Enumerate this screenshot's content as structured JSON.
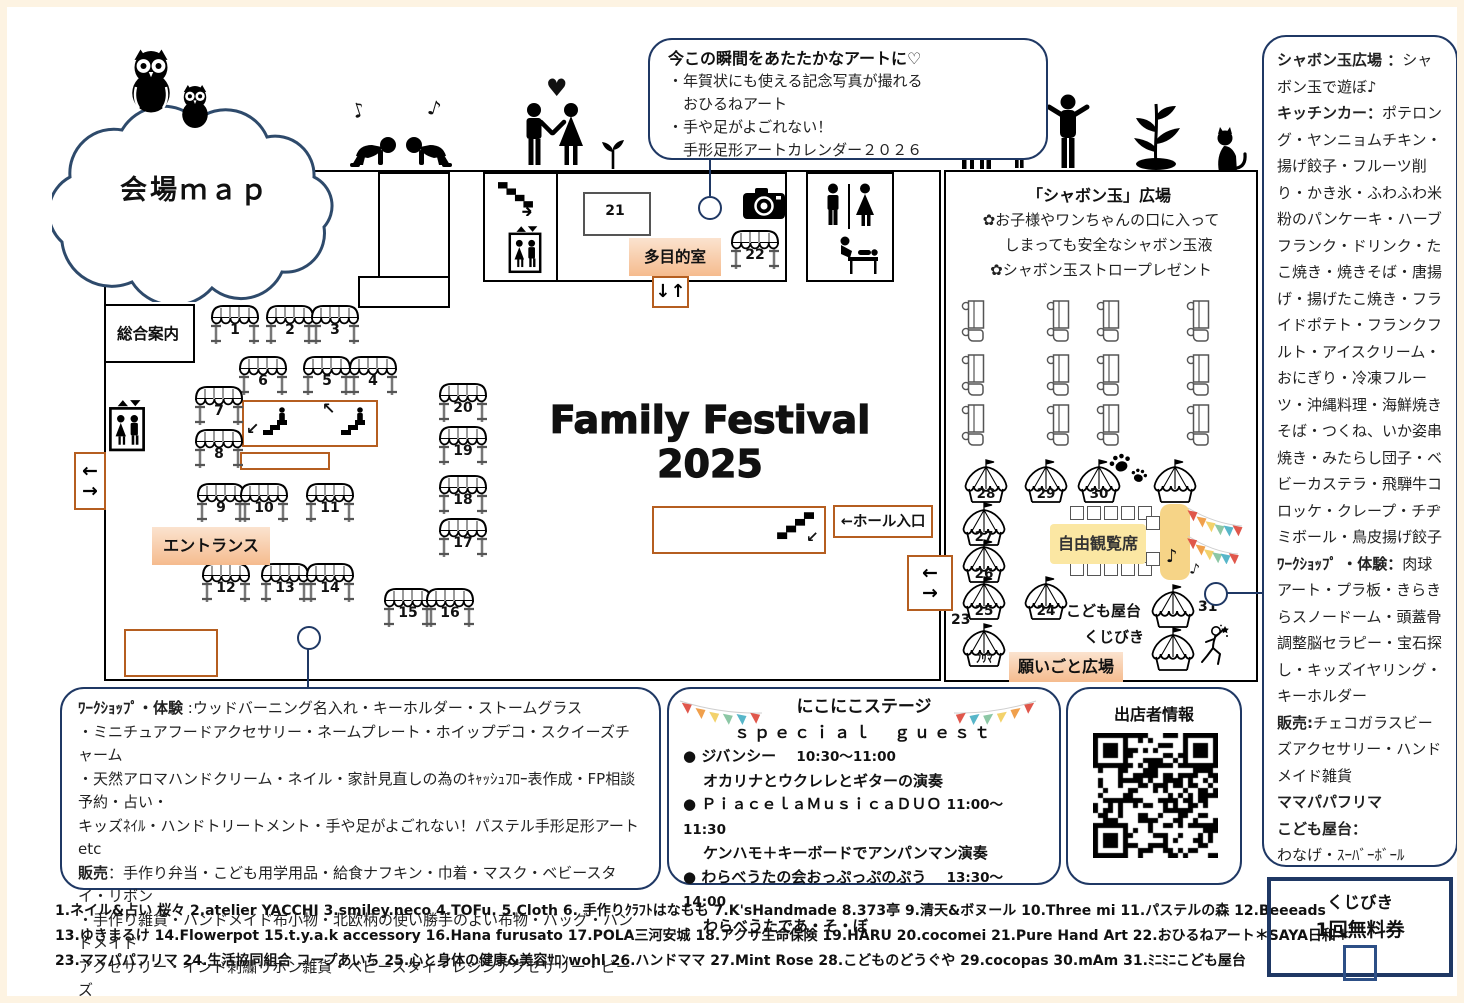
{
  "cloud": {
    "title": "会場ｍａｐ"
  },
  "festival_title": "Family Festival 2025",
  "labels": {
    "info_desk": "総合案内",
    "entrance": "エントランス",
    "multi_room": "多目的室",
    "room21": "21",
    "hall_entrance": "←ホール入口",
    "wish_plaza": "願いごと広場",
    "free_seats": "自由観覧席",
    "kids_stall": "こども屋台",
    "kujibiki": "くじびき",
    "flea": "ﾌﾘﾏ"
  },
  "icons": {
    "music_note": "♪",
    "heart": "♥",
    "up_down": "↓↑",
    "left_arrow": "←",
    "right_arrow": "→",
    "down_left": "↙",
    "up_left": "↖",
    "bullet": "●"
  },
  "bubble": {
    "title": "今この瞬間をあたたかなアートに♡",
    "lines": [
      "・年賀状にも使える記念写真が撮れる",
      "　おひるねアート",
      "・手や足がよごれない！",
      "　手形足形アートカレンダー２０２６"
    ]
  },
  "shabon": {
    "title": "「シャボン玉」広場",
    "lines": [
      "✿お子様やワンちゃんの口に入って",
      "　しまっても安全なシャボン玉液",
      "✿シャボン玉ストロープレゼント"
    ]
  },
  "right_panel": {
    "runs": [
      {
        "b": 1,
        "t": "シャボン玉広場 ："
      },
      {
        "b": 0,
        "t": "シャボン玉で遊ぼ♪"
      },
      {
        "b": 1,
        "t": "キッチンカー：",
        "nl": 1
      },
      {
        "b": 0,
        "t": "ポテロング・ヤンニョムチキン・揚げ餃子・フルーツ削り・かき氷・ふわふわ米粉のパンケーキ・ハーブフランク・ドリンク・たこ焼き・焼きそば・唐揚げ・揚げたこ焼き・フライドポテト・フランクフルト・アイスクリーム・おにぎり・冷凍フルーツ・沖縄料理・海鮮焼きそば・つくね、いか姿串焼き・みたらし団子・ベビーカステラ・飛騨牛コロッケ・クレープ・チヂミボール・鳥皮揚げ餃子"
      },
      {
        "b": 1,
        "t": "ﾜｰｸｼｮｯﾌﾟ ・体験：",
        "nl": 1
      },
      {
        "b": 0,
        "t": "肉球アート・プラ板・きらきらスノードーム・頭蓋骨調整脳セラピー・宝石探し・キッズイヤリング・キーホルダー"
      },
      {
        "b": 1,
        "t": "販売:",
        "nl": 1
      },
      {
        "b": 0,
        "t": "チェコガラスビーズアクセサリー・ハンドメイド雑貨"
      },
      {
        "b": 1,
        "t": "ママパパフリマ",
        "nl": 1
      },
      {
        "b": 1,
        "t": "こども屋台：",
        "nl": 1
      },
      {
        "b": 0,
        "t": "わなげ・ｽｰﾊﾞｰﾎﾞｰﾙ",
        "nl": 1
      }
    ]
  },
  "workshop_panel": {
    "runs": [
      {
        "b": 1,
        "t": "ﾜｰｸｼｮｯﾌﾟ・体験"
      },
      {
        "b": 0,
        "t": " :ウッドバーニング名入れ・キーホルダー・ストームグラス"
      },
      {
        "b": 0,
        "t": "・ミニチュアフードアクセサリー・ネームプレート・ホイップデコ・スクイーズチャーム",
        "nl": 1
      },
      {
        "b": 0,
        "t": "・天然アロマハンドクリーム・ネイル・家計見直しの為のｷｬｯｼｭﾌﾛｰ表作成・FP相談予約・占い・",
        "nl": 1
      },
      {
        "b": 0,
        "t": "キッズﾈｲﾙ・ハンドトリートメント・手や足がよごれない！パステル手形足形アートetc",
        "nl": 1
      },
      {
        "b": 1,
        "t": "販売",
        "nl": 1
      },
      {
        "b": 0,
        "t": "：手作り弁当・こども用学用品・給食ナフキン・巾着・マスク・ベビースタイ・リボン"
      },
      {
        "b": 0,
        "t": "・手作り雑貨・ハンドメイド布小物・北欧柄の使い勝手のよい布物・バッグ・ハンドメイド",
        "nl": 1
      },
      {
        "b": 0,
        "t": "アクセサリー・インド刺繍リボン雑貨・ベビースタイ・レジンアクセサリー・ビーズ",
        "nl": 1
      },
      {
        "b": 0,
        "t": "アクセサリー・ポリマークレイアクセサリー・キッズアクセサリー・ポーチetc",
        "nl": 1
      }
    ]
  },
  "stage_panel": {
    "title": "にこにこステージ",
    "subtitle": "ｓｐｅｃｉａｌ　ｇｕｅｓｔ",
    "items": [
      {
        "head": "ジバンシー",
        "time": "10:30～11:00",
        "desc": "オカリナとウクレレとギターの演奏"
      },
      {
        "head": "ＰｉａｃｅｌａＭｕｓｉｃａＤＵＯ",
        "time": "11:00～11:30",
        "desc": "ケンハモ＋キーボードでアンパンマン演奏"
      },
      {
        "head": "わらべうたの会おっぷっぷのぷう",
        "time": "13:30～14:00",
        "desc": "わらべうたであ・そ・ぼ"
      }
    ]
  },
  "qr_panel": {
    "title": "出店者情報"
  },
  "coupon": {
    "line1": "くじびき",
    "line2": "1回無料券"
  },
  "vendors": [
    "1.ネイル&占い 桜々 2.atelier YACCHI 3.smiley.neco 4.TOFu. 5.Cloth 6. 手作りｸﾗﾌﾄはなもも 7.K'sHandmade 8.373亭 9.清天&ボヌール 10.Three mi 11.パステルの森 12.Beeeads",
    "13.ゆきまるけ 14.Flowerpot 15.t.y.a.k accessory 16.Hana furusato 17.POLA三河安城  18.アクサ生命保険 19.HARU 20.cocomei 21.Pure Hand Art  22.おひるねアート＊SAYA日和＊",
    "23.ママパパフリマ 24.生活協同組合 コープあいち 25.心と身体の健康&美容ｻﾛﾝwohl 26.ハンドママ 27.Mint Rose 28.こどものどうぐや 29.cocopas 30.mAm 31.ﾐﾆﾐﾆこども屋台"
  ],
  "map": {
    "stalls": [
      "1",
      "2",
      "3",
      "4",
      "5",
      "6",
      "7",
      "8",
      "9",
      "10",
      "11",
      "12",
      "13",
      "14",
      "15",
      "16",
      "17",
      "18",
      "19",
      "20",
      "22"
    ],
    "tents": [
      "23",
      "24",
      "25",
      "26",
      "27",
      "28",
      "29",
      "30",
      "31"
    ],
    "kitchen_trucks": 12,
    "seats": 12
  },
  "colors": {
    "navy": "#1f3864",
    "orange": "#b55e20",
    "bunting": [
      "#e0574b",
      "#f0a04c",
      "#f3d26b",
      "#8cc7a5",
      "#57b6c9"
    ]
  }
}
